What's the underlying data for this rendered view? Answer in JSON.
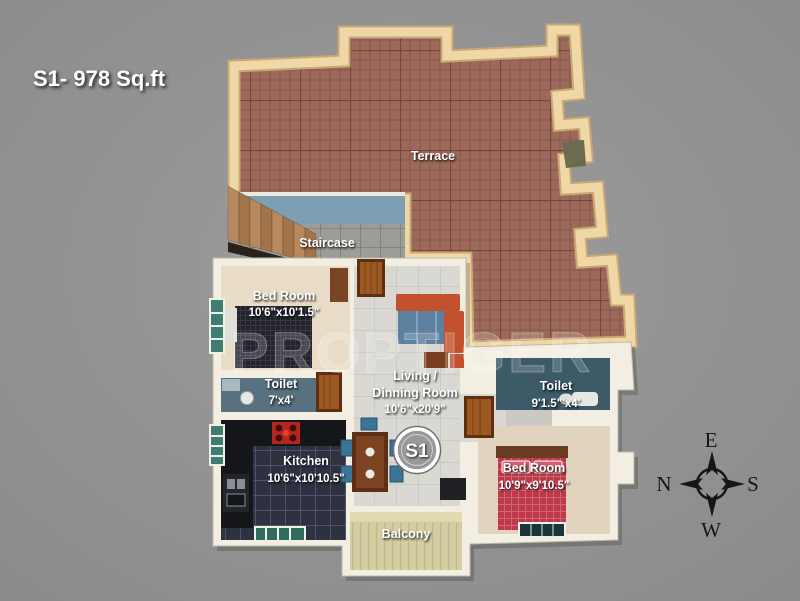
{
  "title": "S1- 978 Sq.ft",
  "watermark": "PROPTIGER",
  "unit_badge": "S1",
  "rooms": {
    "terrace": {
      "name": "Terrace"
    },
    "staircase": {
      "name": "Staircase"
    },
    "bedroom1": {
      "name": "Bed Room",
      "dims": "10'6\"x10'1.5\""
    },
    "toilet1": {
      "name": "Toilet",
      "dims": "7'x4'"
    },
    "living": {
      "name_line1": "Living /",
      "name_line2": "Dinning Room",
      "dims": "10'6\"x20'9\""
    },
    "toilet2": {
      "name": "Toilet",
      "dims": "9'1.5\"'x4'"
    },
    "kitchen": {
      "name": "Kitchen",
      "dims": "10'6\"x10'10.5\""
    },
    "bedroom2": {
      "name": "Bed Room",
      "dims": "10'9\"x9'10.5\""
    },
    "balcony": {
      "name": "Balcony"
    }
  },
  "compass": {
    "top": "E",
    "left": "N",
    "right": "S",
    "bottom": "W"
  },
  "colors": {
    "background": "#949494",
    "terrace_floor": "#9d695b",
    "wall_tan": "#f0d7a6",
    "wall_tan_edge": "#c9a877",
    "wall_white": "#f2eee2",
    "staircase_wall": "#7e9fb2",
    "staircase_floor": "#9c9c98",
    "bedroom_floor": "#e9dcc6",
    "bedroom2_floor": "#e1d3bd",
    "toilet1_floor": "#587180",
    "toilet2_floor": "#3c5a68",
    "kitchen_floor": "#2e3140",
    "kitchen_counter": "#15161a",
    "living_floor": "#d9d8d2",
    "balcony_floor": "#d5cda2",
    "bed_red": "#c0394b",
    "rug_dark": "#23242e",
    "sofa_orange": "#c2512f",
    "sofa_blue": "#5e80a0",
    "door_wood": "#9c5a22",
    "window_teal": "#3f7d72",
    "stove_red": "#b5241f",
    "label_white": "#ffffff",
    "compass_black": "#161616"
  }
}
